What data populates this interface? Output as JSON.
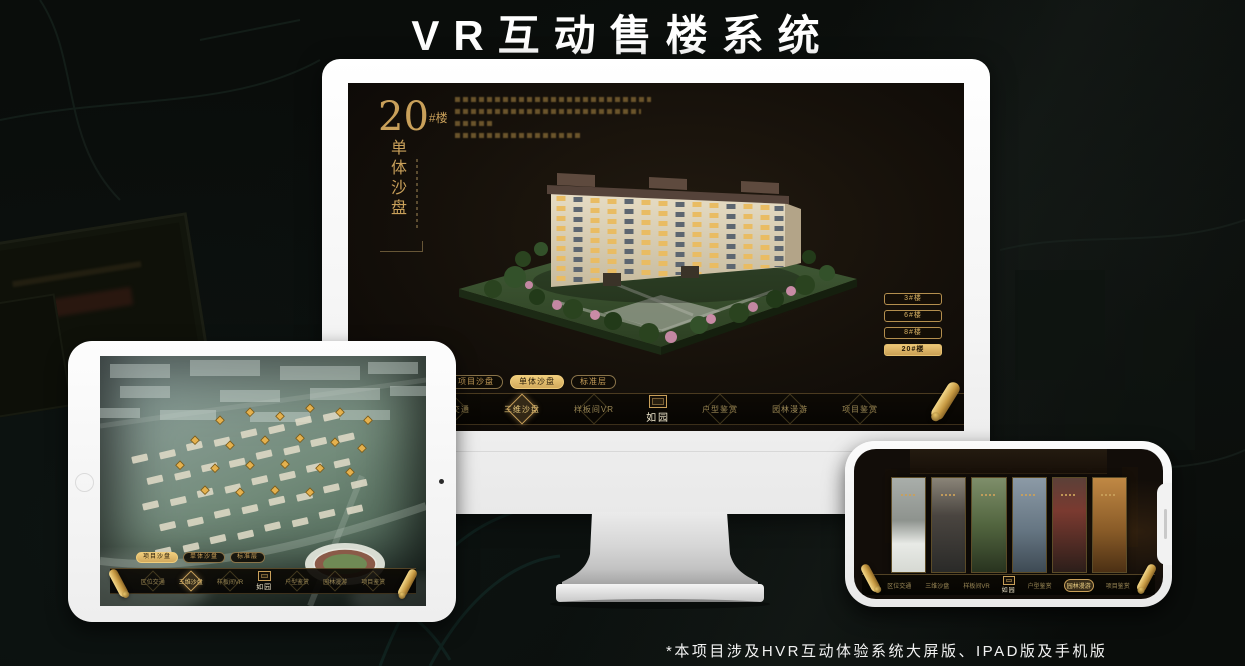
{
  "page": {
    "title": "VR互动售楼系统",
    "footnote": "*本项目涉及HVR互动体验系统大屏版、IPAD版及手机版"
  },
  "colors": {
    "accent_gold": "#c9a05a",
    "accent_gold_bright": "#f0cd7c",
    "screen_background": "#15100a",
    "page_background": "#0a0d0b"
  },
  "monitor": {
    "headline": {
      "number": "20",
      "suffix": "#楼",
      "subtitle": "单体沙盘"
    },
    "floor_buttons": [
      {
        "label": "3#楼",
        "active": false
      },
      {
        "label": "6#楼",
        "active": false
      },
      {
        "label": "8#楼",
        "active": false
      },
      {
        "label": "20#楼",
        "active": true
      }
    ],
    "sub_tabs": [
      {
        "label": "项目沙盘",
        "active": false
      },
      {
        "label": "单体沙盘",
        "active": true
      },
      {
        "label": "标准层",
        "active": false
      }
    ],
    "nav": {
      "logo": "如园",
      "items": [
        {
          "label": "区位交通",
          "active": false
        },
        {
          "label": "三维沙盘",
          "active": true
        },
        {
          "label": "样板间VR",
          "active": false
        },
        {
          "label": "户型鉴赏",
          "active": false
        },
        {
          "label": "园林漫游",
          "active": false
        },
        {
          "label": "项目鉴赏",
          "active": false
        }
      ],
      "scroll_icon": "scroll-menu-icon"
    }
  },
  "tablet": {
    "sub_tabs": [
      {
        "label": "项目沙盘",
        "active": true
      },
      {
        "label": "单体沙盘",
        "active": false
      },
      {
        "label": "标准层",
        "active": false
      }
    ],
    "nav": {
      "logo": "如园",
      "items": [
        {
          "label": "区位交通",
          "active": false
        },
        {
          "label": "三维沙盘",
          "active": true
        },
        {
          "label": "样板间VR",
          "active": false
        },
        {
          "label": "户型鉴赏",
          "active": false
        },
        {
          "label": "园林漫游",
          "active": false
        },
        {
          "label": "项目鉴赏",
          "active": false
        }
      ]
    }
  },
  "phone": {
    "nav": {
      "logo": "如园",
      "items": [
        {
          "label": "区位交通",
          "active": false
        },
        {
          "label": "三维沙盘",
          "active": false
        },
        {
          "label": "样板间VR",
          "active": false
        },
        {
          "label": "户型鉴赏",
          "active": false
        },
        {
          "label": "园林漫游",
          "active": true
        },
        {
          "label": "项目鉴赏",
          "active": false
        }
      ]
    }
  }
}
